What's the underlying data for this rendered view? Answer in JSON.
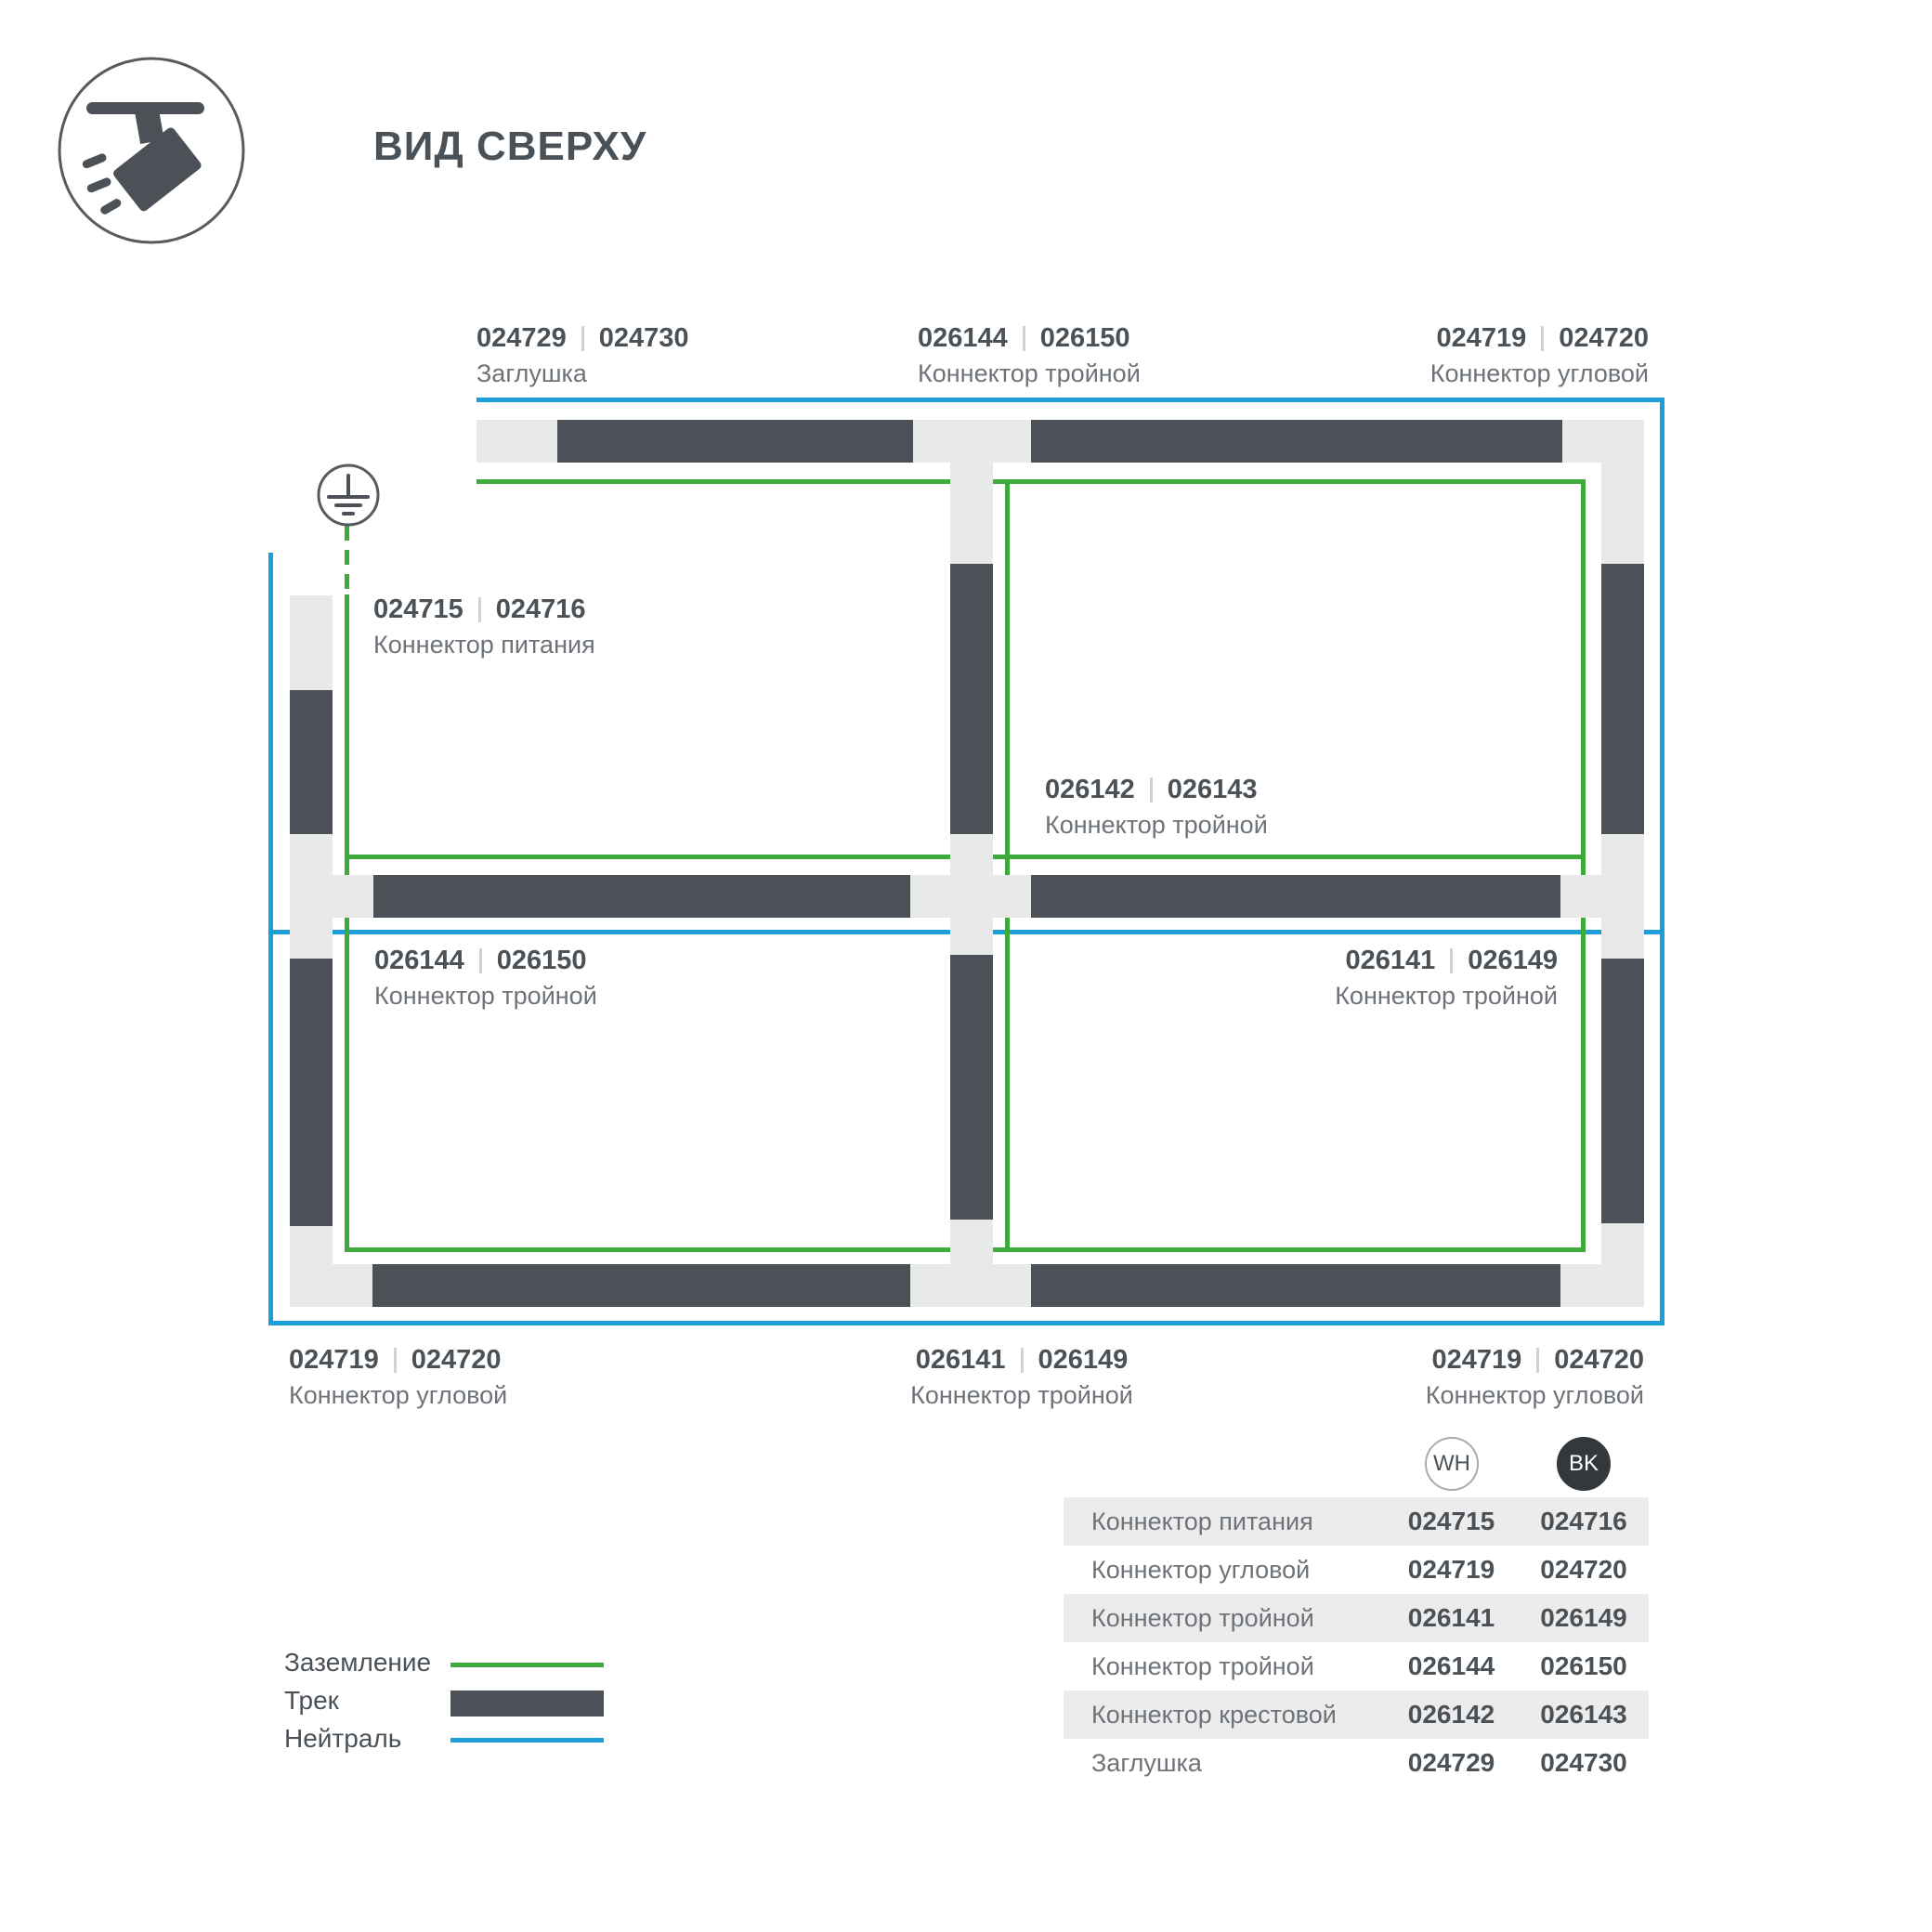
{
  "title": "ВИД СВЕРХУ",
  "colors": {
    "ground": "#3faa3c",
    "neutral": "#1e9ed9",
    "track": "#4b5157",
    "band": "#e8eaea",
    "text_dark": "#4a5157",
    "text_gray": "#6d7378",
    "row_bg": "#ececed",
    "badge_bk_bg": "#33383d",
    "separator": "#cfd2d3",
    "outline": "#565b60"
  },
  "icons": {
    "header": "track-light-icon",
    "ground": "ground-earth-icon"
  },
  "diagram": {
    "labels": {
      "top_left": {
        "wh": "024729",
        "bk": "024730",
        "name": "Заглушка"
      },
      "top_center": {
        "wh": "026144",
        "bk": "026150",
        "name": "Коннектор тройной"
      },
      "top_right": {
        "wh": "024719",
        "bk": "024720",
        "name": "Коннектор угловой"
      },
      "power": {
        "wh": "024715",
        "bk": "024716",
        "name": "Коннектор питания"
      },
      "center": {
        "wh": "026142",
        "bk": "026143",
        "name": "Коннектор тройной"
      },
      "mid_left": {
        "wh": "026144",
        "bk": "026150",
        "name": "Коннектор тройной"
      },
      "mid_right": {
        "wh": "026141",
        "bk": "026149",
        "name": "Коннектор тройной"
      },
      "bottom_left": {
        "wh": "024719",
        "bk": "024720",
        "name": "Коннектор угловой"
      },
      "bottom_center": {
        "wh": "026141",
        "bk": "026149",
        "name": "Коннектор тройной"
      },
      "bottom_right": {
        "wh": "024719",
        "bk": "024720",
        "name": "Коннектор угловой"
      }
    }
  },
  "legend": [
    {
      "label": "Заземление",
      "type": "ground"
    },
    {
      "label": "Трек",
      "type": "track"
    },
    {
      "label": "Нейтраль",
      "type": "neutral"
    }
  ],
  "table": {
    "columns": [
      "WH",
      "BK"
    ],
    "rows": [
      {
        "name": "Коннектор питания",
        "wh": "024715",
        "bk": "024716"
      },
      {
        "name": "Коннектор угловой",
        "wh": "024719",
        "bk": "024720"
      },
      {
        "name": "Коннектор тройной",
        "wh": "026141",
        "bk": "026149"
      },
      {
        "name": "Коннектор тройной",
        "wh": "026144",
        "bk": "026150"
      },
      {
        "name": "Коннектор крестовой",
        "wh": "026142",
        "bk": "026143"
      },
      {
        "name": "Заглушка",
        "wh": "024729",
        "bk": "024730"
      }
    ]
  }
}
